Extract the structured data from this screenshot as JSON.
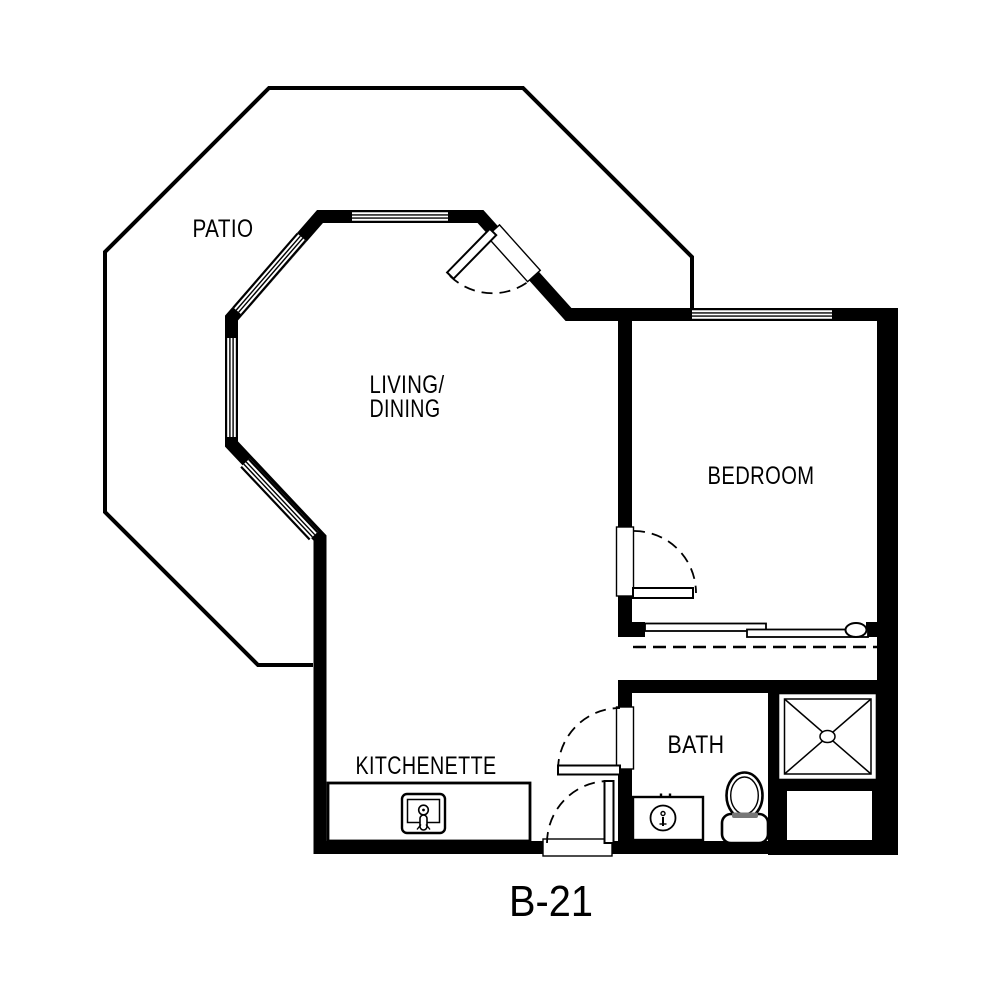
{
  "plan": {
    "unit_label": "B-21",
    "rooms": [
      {
        "name": "patio",
        "label": "PATIO"
      },
      {
        "name": "living-dining",
        "label_line1": "LIVING/",
        "label_line2": "DINING"
      },
      {
        "name": "bedroom",
        "label": "BEDROOM"
      },
      {
        "name": "kitchenette",
        "label": "KITCHENETTE"
      },
      {
        "name": "bath",
        "label": "BATH"
      }
    ],
    "fixtures": [
      "shower",
      "toilet",
      "bath-sink-vanity",
      "kitchen-sink-counter",
      "closet-sliding-door",
      "closet-rod",
      "patio-door",
      "bedroom-door",
      "bath-door",
      "entry-door",
      "windows"
    ],
    "colors": {
      "wall": "#000000",
      "background": "#ffffff",
      "line": "#000000"
    }
  }
}
